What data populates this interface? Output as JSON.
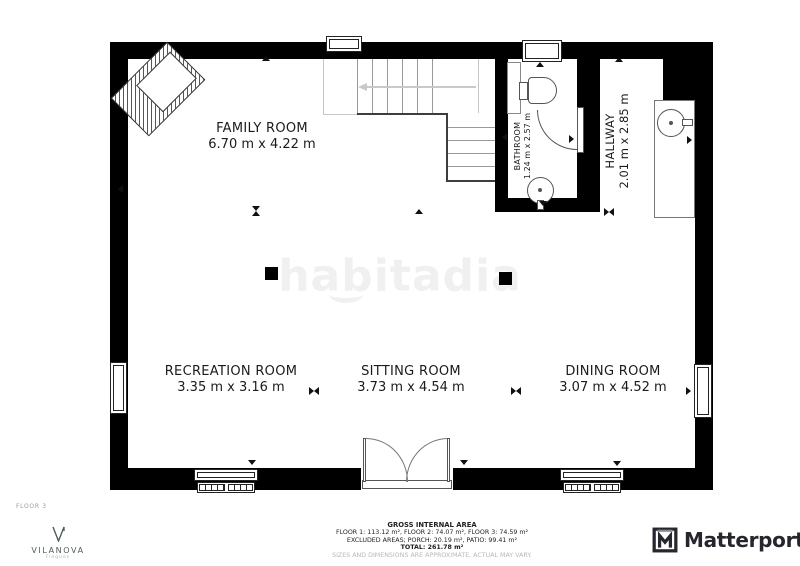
{
  "watermark": {
    "text": "habitadia"
  },
  "rooms": [
    {
      "name": "FAMILY ROOM",
      "dims": "6.70 m x 4.22 m"
    },
    {
      "name": "RECREATION ROOM",
      "dims": "3.35 m x 3.16 m"
    },
    {
      "name": "SITTING ROOM",
      "dims": "3.73 m x 4.54 m"
    },
    {
      "name": "DINING ROOM",
      "dims": "3.07 m x 4.52 m"
    },
    {
      "name": "BATHROOM",
      "dims": "1.24 m x 2.57 m"
    },
    {
      "name": "HALLWAY",
      "dims": "2.01 m x 2.85 m"
    }
  ],
  "fixtures": [
    "staircase",
    "toilet",
    "bathroom-sink",
    "bathroom-door",
    "shower-cabinet",
    "hall-washbasin",
    "french-doors",
    "radiators",
    "windows",
    "columns",
    "armchair"
  ],
  "footer": {
    "floor_label": "FLOOR 3",
    "area_title": "GROSS INTERNAL AREA",
    "area_line1": "FLOOR 1: 113.12 m², FLOOR 2: 74.07 m², FLOOR 3: 74.59 m²",
    "area_line2": "EXCLUDED AREAS; PORCH: 20.19 m², PATIO: 99.41 m²",
    "area_total": "TOTAL: 261.78 m²",
    "disclaimer": "SIZES AND DIMENSIONS ARE APPROXIMATE, ACTUAL MAY VARY."
  },
  "branding": {
    "agency_name": "VILANOVA",
    "agency_sub": "Finques",
    "platform_name": "Matterport"
  },
  "colors": {
    "wall": "#000000",
    "agency_green": "#4e5e57",
    "matterport_dark": "#26262e",
    "watermark_gray": "#f0f0f0"
  }
}
